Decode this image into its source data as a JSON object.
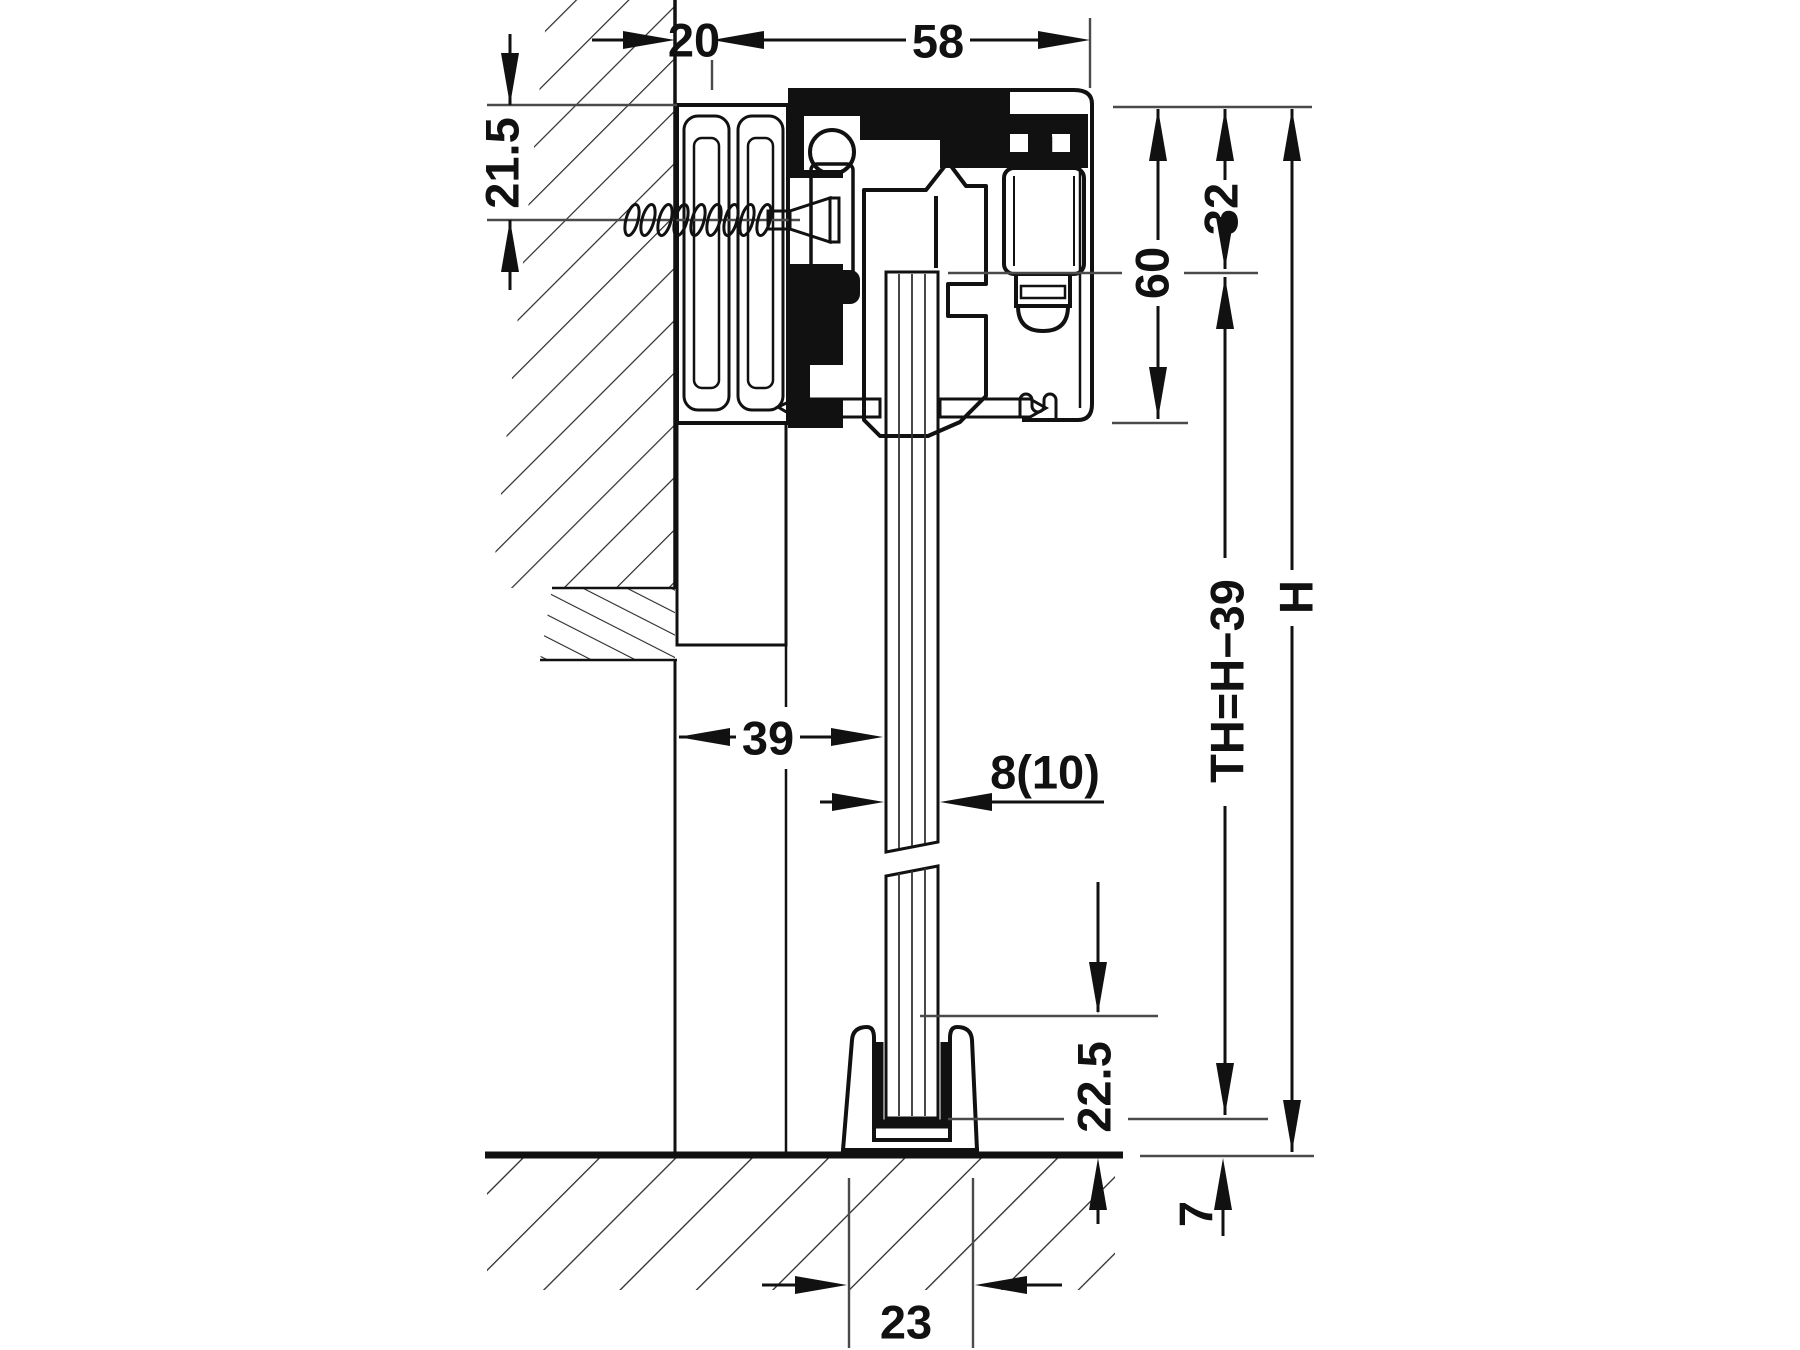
{
  "drawing_type": "sliding-door-fitting-cross-section",
  "dimensions": {
    "wall_to_track": "20",
    "track_width": "58",
    "screw_axis_offset": "21.5",
    "track_top_to_hanger": "32",
    "track_height": "60",
    "wall_to_glass": "39",
    "glass_thickness": "8(10)",
    "door_height_formula": "TH=H−39",
    "total_height": "H",
    "floor_guide_height": "22.5",
    "glass_bottom_to_floor": "7",
    "floor_guide_width": "23"
  },
  "colors": {
    "line": "#111111",
    "reference_line": "#4a4a4a",
    "component_fill": "#d6d6d6",
    "glass_fill": "#ffffff",
    "background": "#ffffff"
  }
}
